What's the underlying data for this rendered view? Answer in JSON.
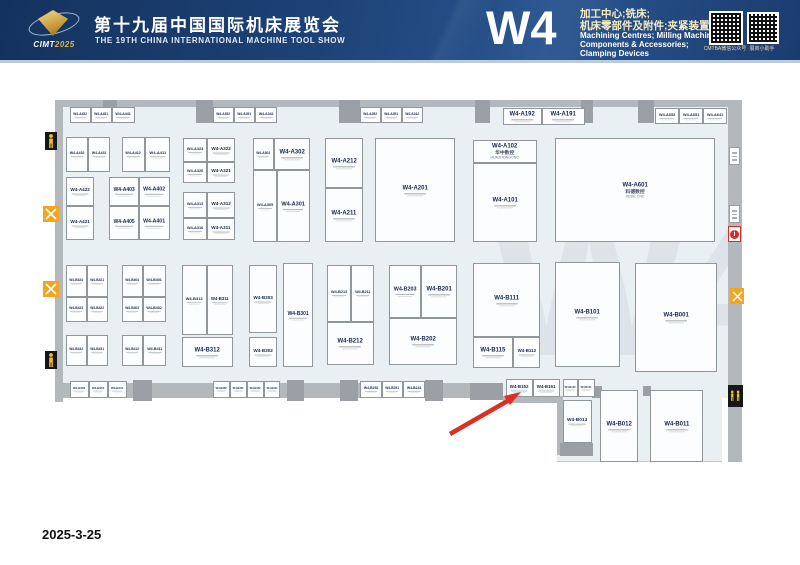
{
  "header": {
    "logo_brand": "CIMT",
    "logo_year": "2025",
    "title_zh": "第十九届中国国际机床展览会",
    "title_en": "THE 19TH CHINA INTERNATIONAL MACHINE TOOL SHOW",
    "hall_code": "W4",
    "desc_zh1": "加工中心;铣床;",
    "desc_zh2": "机床零部件及附件;夹紧装置",
    "desc_en1": "Machining Centres; Milling Machines;",
    "desc_en2": "Components & Accessories;",
    "desc_en3": "Clamping Devices",
    "qr1_caption": "CMTBA微信公众号",
    "qr2_caption": "展商小助手"
  },
  "footer": {
    "date": "2025-3-25"
  },
  "colors": {
    "header_bg": "#1d4276",
    "floor": "#e9f0f4",
    "wall": "#b3b8bc",
    "booth_border": "#8f979c",
    "booth_number": "#17294e",
    "arrow_red": "#dd2f24",
    "icon_orange": "#f2a51f",
    "icon_yellow": "#f2c01e"
  },
  "plan": {
    "watermark": "W4",
    "icons": [
      "entrance-person-icon",
      "restaurant-icon",
      "restaurant-icon",
      "entrance-person-icon",
      "wall-sign",
      "wall-sign",
      "first-aid-icon",
      "restaurant-icon",
      "restroom-icon"
    ],
    "annotation": {
      "type": "red-arrow",
      "points_to": "bottom wall booth row near W4-B152"
    },
    "booths": [
      {
        "id": "W4-A432",
        "x": 66,
        "y": 75,
        "w": 22,
        "h": 35
      },
      {
        "id": "W4-A431",
        "x": 88,
        "y": 75,
        "w": 22,
        "h": 35
      },
      {
        "id": "W4-A412",
        "x": 122,
        "y": 75,
        "w": 23,
        "h": 35
      },
      {
        "id": "W4-A411",
        "x": 145,
        "y": 75,
        "w": 25,
        "h": 35
      },
      {
        "id": "W4-A422",
        "x": 66,
        "y": 115,
        "w": 28,
        "h": 29
      },
      {
        "id": "W4-A421",
        "x": 66,
        "y": 144,
        "w": 28,
        "h": 34
      },
      {
        "id": "W4-A403",
        "x": 109,
        "y": 115,
        "w": 30,
        "h": 29
      },
      {
        "id": "W4-A402",
        "x": 139,
        "y": 115,
        "w": 31,
        "h": 29
      },
      {
        "id": "W4-A405",
        "x": 109,
        "y": 144,
        "w": 30,
        "h": 34
      },
      {
        "id": "W4-A401",
        "x": 139,
        "y": 144,
        "w": 31,
        "h": 34
      },
      {
        "id": "W4-A323",
        "x": 183,
        "y": 76,
        "w": 24,
        "h": 24
      },
      {
        "id": "W4-A322",
        "x": 207,
        "y": 76,
        "w": 28,
        "h": 24
      },
      {
        "id": "W4-A326",
        "x": 183,
        "y": 100,
        "w": 24,
        "h": 21
      },
      {
        "id": "W4-A321",
        "x": 207,
        "y": 100,
        "w": 28,
        "h": 21
      },
      {
        "id": "W4-A313",
        "x": 183,
        "y": 130,
        "w": 24,
        "h": 26
      },
      {
        "id": "W4-A312",
        "x": 207,
        "y": 130,
        "w": 28,
        "h": 26
      },
      {
        "id": "W4-A316",
        "x": 183,
        "y": 156,
        "w": 24,
        "h": 22
      },
      {
        "id": "W4-A311",
        "x": 207,
        "y": 156,
        "w": 28,
        "h": 22
      },
      {
        "id": "W4-A303",
        "x": 253,
        "y": 76,
        "w": 21,
        "h": 32
      },
      {
        "id": "W4-A302",
        "x": 274,
        "y": 76,
        "w": 36,
        "h": 32
      },
      {
        "id": "W4-A305",
        "x": 253,
        "y": 108,
        "w": 24,
        "h": 72
      },
      {
        "id": "W4-A301",
        "x": 277,
        "y": 108,
        "w": 33,
        "h": 72
      },
      {
        "id": "W4-A212",
        "x": 325,
        "y": 76,
        "w": 38,
        "h": 50
      },
      {
        "id": "W4-A211",
        "x": 325,
        "y": 126,
        "w": 38,
        "h": 54
      },
      {
        "id": "W4-A201",
        "x": 375,
        "y": 76,
        "w": 80,
        "h": 104
      },
      {
        "id": "W4-A102",
        "x": 473,
        "y": 78,
        "w": 64,
        "h": 23,
        "nz": "华中数控",
        "ne": "HUAZHONGCNC"
      },
      {
        "id": "W4-A101",
        "x": 473,
        "y": 101,
        "w": 64,
        "h": 79
      },
      {
        "id": "W4-A601",
        "x": 555,
        "y": 76,
        "w": 160,
        "h": 104,
        "nz": "科德数控",
        "ne": "KEDE CNC"
      },
      {
        "id": "W4-B424",
        "x": 66,
        "y": 203,
        "w": 21,
        "h": 32
      },
      {
        "id": "W4-B421",
        "x": 87,
        "y": 203,
        "w": 21,
        "h": 32
      },
      {
        "id": "W4-B423",
        "x": 66,
        "y": 235,
        "w": 21,
        "h": 25
      },
      {
        "id": "W4-B422",
        "x": 87,
        "y": 235,
        "w": 21,
        "h": 25
      },
      {
        "id": "W4-B404",
        "x": 122,
        "y": 203,
        "w": 21,
        "h": 32
      },
      {
        "id": "W4-B401",
        "x": 143,
        "y": 203,
        "w": 23,
        "h": 32
      },
      {
        "id": "W4-B403",
        "x": 122,
        "y": 235,
        "w": 21,
        "h": 25
      },
      {
        "id": "W4-B402",
        "x": 143,
        "y": 235,
        "w": 23,
        "h": 25
      },
      {
        "id": "W4-B432",
        "x": 66,
        "y": 273,
        "w": 21,
        "h": 31
      },
      {
        "id": "W4-B431",
        "x": 87,
        "y": 273,
        "w": 21,
        "h": 31
      },
      {
        "id": "W4-B412",
        "x": 122,
        "y": 273,
        "w": 21,
        "h": 31
      },
      {
        "id": "W4-B411",
        "x": 143,
        "y": 273,
        "w": 23,
        "h": 31
      },
      {
        "id": "W4-B313",
        "x": 182,
        "y": 203,
        "w": 25,
        "h": 70
      },
      {
        "id": "W4-B311",
        "x": 207,
        "y": 203,
        "w": 26,
        "h": 70
      },
      {
        "id": "W4-B312",
        "x": 182,
        "y": 275,
        "w": 51,
        "h": 30
      },
      {
        "id": "W4-B303",
        "x": 249,
        "y": 203,
        "w": 28,
        "h": 68
      },
      {
        "id": "W4-B302",
        "x": 249,
        "y": 275,
        "w": 28,
        "h": 30
      },
      {
        "id": "W4-B301",
        "x": 283,
        "y": 201,
        "w": 30,
        "h": 104
      },
      {
        "id": "W4-B213",
        "x": 327,
        "y": 203,
        "w": 24,
        "h": 57
      },
      {
        "id": "W4-B211",
        "x": 351,
        "y": 203,
        "w": 23,
        "h": 57
      },
      {
        "id": "W4-B212",
        "x": 327,
        "y": 260,
        "w": 47,
        "h": 43
      },
      {
        "id": "W4-B203",
        "x": 389,
        "y": 203,
        "w": 32,
        "h": 53
      },
      {
        "id": "W4-B201",
        "x": 421,
        "y": 203,
        "w": 36,
        "h": 53
      },
      {
        "id": "W4-B202",
        "x": 389,
        "y": 256,
        "w": 68,
        "h": 47
      },
      {
        "id": "W4-B111",
        "x": 473,
        "y": 201,
        "w": 67,
        "h": 74
      },
      {
        "id": "W4-B115",
        "x": 473,
        "y": 275,
        "w": 40,
        "h": 31
      },
      {
        "id": "W4-B112",
        "x": 513,
        "y": 275,
        "w": 27,
        "h": 31
      },
      {
        "id": "W4-B101",
        "x": 555,
        "y": 200,
        "w": 65,
        "h": 105
      },
      {
        "id": "W4-B001",
        "x": 635,
        "y": 201,
        "w": 82,
        "h": 109
      },
      {
        "id": "W4-B013",
        "x": 563,
        "y": 338,
        "w": 29,
        "h": 43
      },
      {
        "id": "W4-B012",
        "x": 600,
        "y": 328,
        "w": 38,
        "h": 72
      },
      {
        "id": "W4-B011",
        "x": 650,
        "y": 328,
        "w": 53,
        "h": 72
      },
      {
        "id": "W4-A452",
        "x": 70,
        "y": 45,
        "w": 21,
        "h": 16
      },
      {
        "id": "W4-A451",
        "x": 91,
        "y": 45,
        "w": 21,
        "h": 16
      },
      {
        "id": "W4-A441",
        "x": 112,
        "y": 45,
        "w": 23,
        "h": 16
      },
      {
        "id": "W4-A352",
        "x": 213,
        "y": 45,
        "w": 21,
        "h": 16
      },
      {
        "id": "W4-A351",
        "x": 234,
        "y": 45,
        "w": 21,
        "h": 16
      },
      {
        "id": "W4-A342",
        "x": 255,
        "y": 45,
        "w": 22,
        "h": 16
      },
      {
        "id": "W4-A252",
        "x": 360,
        "y": 45,
        "w": 21,
        "h": 16
      },
      {
        "id": "W4-A251",
        "x": 381,
        "y": 45,
        "w": 21,
        "h": 16
      },
      {
        "id": "W4-A242",
        "x": 402,
        "y": 45,
        "w": 21,
        "h": 16
      },
      {
        "id": "W4-A192",
        "x": 503,
        "y": 46,
        "w": 39,
        "h": 17
      },
      {
        "id": "W4-A191",
        "x": 542,
        "y": 46,
        "w": 43,
        "h": 17
      },
      {
        "id": "W4-A652",
        "x": 655,
        "y": 46,
        "w": 24,
        "h": 16
      },
      {
        "id": "W4-A651",
        "x": 679,
        "y": 46,
        "w": 24,
        "h": 16
      },
      {
        "id": "W4-A641",
        "x": 703,
        "y": 46,
        "w": 24,
        "h": 16
      },
      {
        "id": "W4-B452",
        "x": 70,
        "y": 319,
        "w": 19,
        "h": 17
      },
      {
        "id": "W4-B451",
        "x": 89,
        "y": 319,
        "w": 19,
        "h": 17
      },
      {
        "id": "W4-B441",
        "x": 108,
        "y": 319,
        "w": 19,
        "h": 17
      },
      {
        "id": "W4-B352",
        "x": 213,
        "y": 319,
        "w": 17,
        "h": 17
      },
      {
        "id": "W4-B351",
        "x": 230,
        "y": 319,
        "w": 17,
        "h": 17
      },
      {
        "id": "W4-B342",
        "x": 247,
        "y": 319,
        "w": 17,
        "h": 17
      },
      {
        "id": "W4-B341",
        "x": 264,
        "y": 319,
        "w": 16,
        "h": 17
      },
      {
        "id": "W4-B252",
        "x": 360,
        "y": 319,
        "w": 22,
        "h": 17
      },
      {
        "id": "W4-B251",
        "x": 382,
        "y": 319,
        "w": 21,
        "h": 17
      },
      {
        "id": "W4-B241",
        "x": 403,
        "y": 319,
        "w": 22,
        "h": 17
      },
      {
        "id": "W4-B152",
        "x": 506,
        "y": 317,
        "w": 27,
        "h": 18
      },
      {
        "id": "W4-B151",
        "x": 533,
        "y": 317,
        "w": 27,
        "h": 18
      },
      {
        "id": "W4-B142",
        "x": 563,
        "y": 317,
        "w": 15,
        "h": 18
      },
      {
        "id": "W4-B141",
        "x": 578,
        "y": 317,
        "w": 17,
        "h": 18
      }
    ]
  }
}
